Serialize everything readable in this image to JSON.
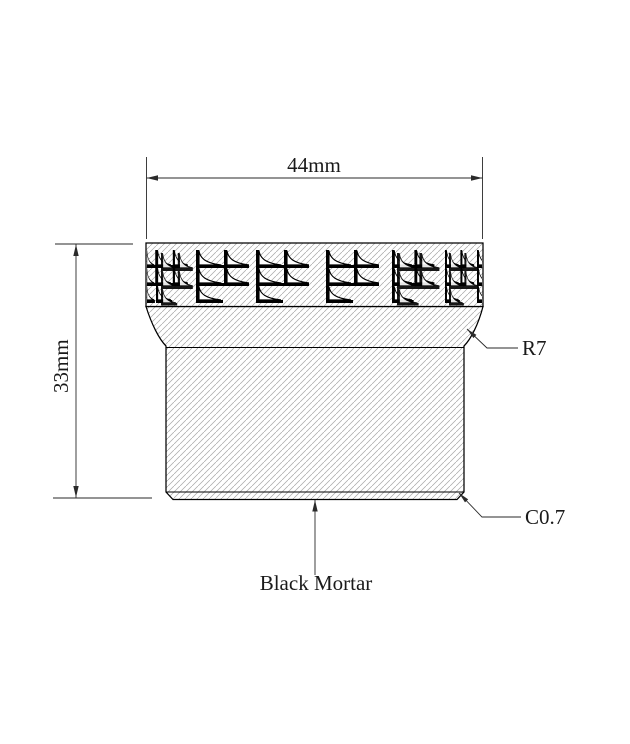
{
  "drawing": {
    "title_hint": "mortar head cross-section drawing",
    "width_dim_label": "44mm",
    "height_dim_label": "33mm",
    "radius_callout_label": "R7",
    "chamfer_callout_label": "C0.7",
    "material_label": "Black Mortar",
    "colors": {
      "line": "#000000",
      "hatch": "#a8a8a8",
      "background": "#ffffff"
    }
  }
}
